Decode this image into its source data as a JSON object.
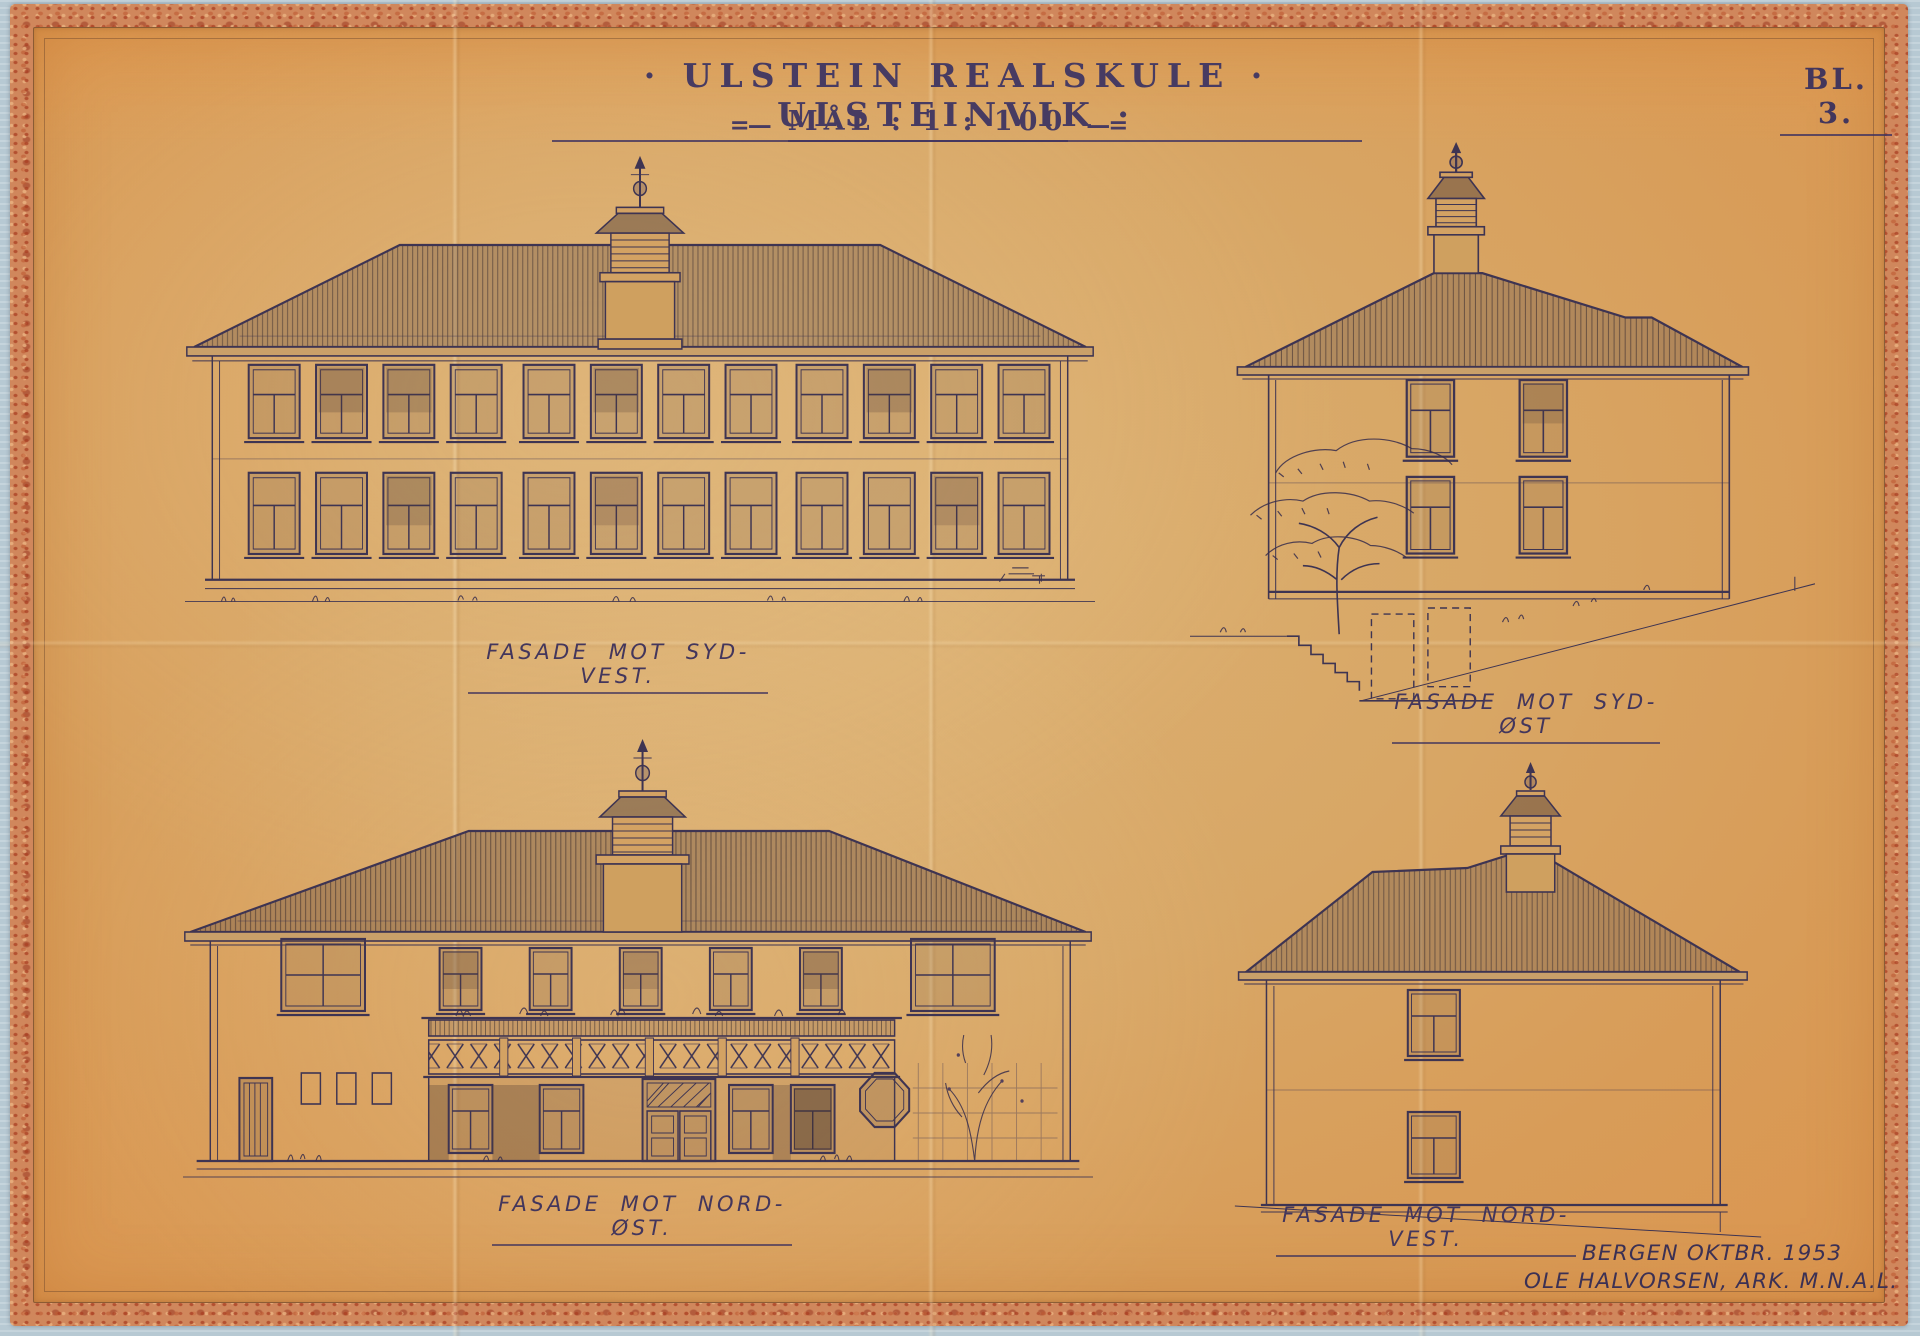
{
  "document": {
    "title": "· ULSTEIN REALSKULE · ULSTEINVIK ·",
    "scale_prefix": "=—",
    "scale_label": "MÅL : 1 : 100",
    "scale_suffix": "—=",
    "sheet_number": "BL. 3.",
    "elevations": [
      {
        "id": "syd-vest",
        "label": "FASADE MOT SYD-VEST."
      },
      {
        "id": "syd-ost",
        "label": "FASADE MOT SYD-ØST"
      },
      {
        "id": "nord-ost",
        "label": "FASADE MOT NORD-ØST."
      },
      {
        "id": "nord-vest",
        "label": "FASADE MOT NORD-VEST."
      }
    ],
    "signature": {
      "line1": "BERGEN OKTBR. 1953",
      "line2": "OLE HALVORSEN, ARK. M.N.A.L."
    },
    "colors": {
      "paper": "#d8a463",
      "border_tape": "#cd7f55",
      "ink": "#3e3452",
      "backing": "#b7c9d3"
    }
  }
}
